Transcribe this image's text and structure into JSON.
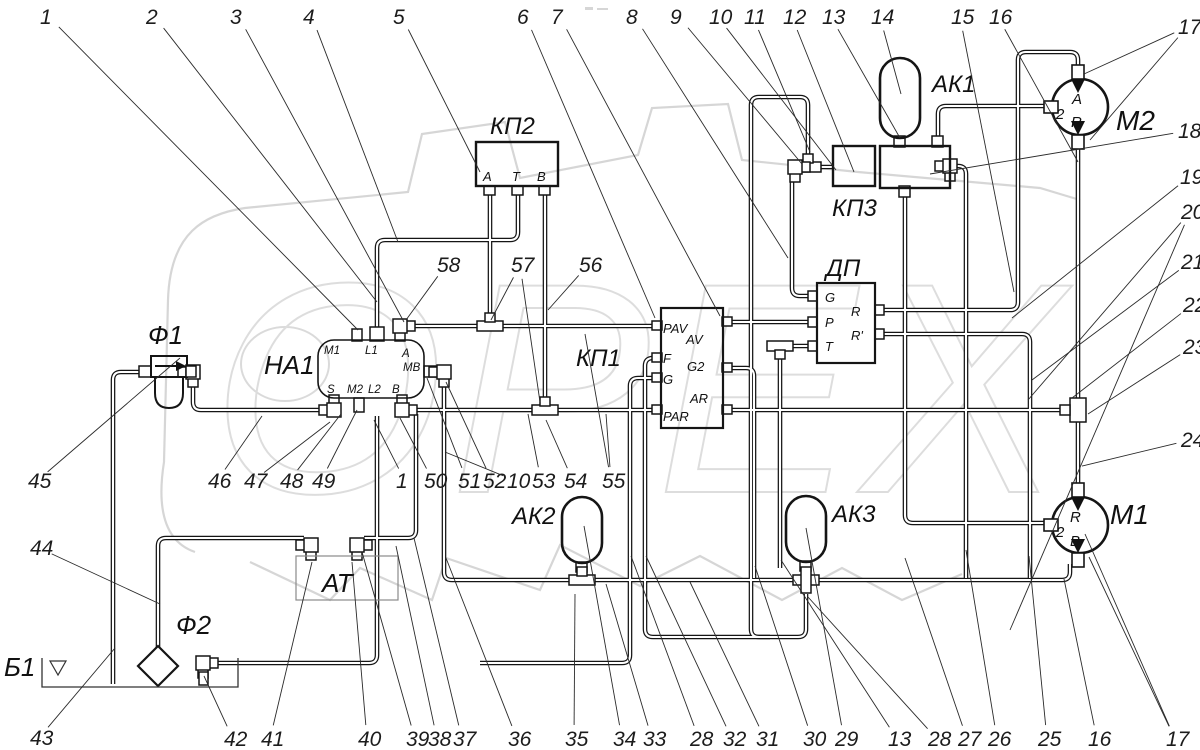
{
  "watermark": {
    "text": "ОРЕХ"
  },
  "blocks": [
    {
      "id": "kp2",
      "label": "КП2",
      "label_pos": [
        490,
        134
      ],
      "ports": [
        {
          "t": "А",
          "p": [
            483,
            181
          ]
        },
        {
          "t": "Т",
          "p": [
            512,
            181
          ]
        },
        {
          "t": "В",
          "p": [
            537,
            181
          ]
        }
      ]
    },
    {
      "id": "kp3",
      "label": "КП3",
      "label_pos": [
        832,
        216
      ],
      "ports": []
    },
    {
      "id": "na1",
      "label": "НА1",
      "label_pos": [
        264,
        374
      ],
      "ports": [
        {
          "t": "M1",
          "p": [
            324,
            354
          ]
        },
        {
          "t": "L1",
          "p": [
            365,
            354
          ]
        },
        {
          "t": "A",
          "p": [
            402,
            357
          ]
        },
        {
          "t": "MB",
          "p": [
            403,
            371
          ]
        },
        {
          "t": "S",
          "p": [
            327,
            393
          ]
        },
        {
          "t": "M2",
          "p": [
            347,
            393
          ]
        },
        {
          "t": "L2",
          "p": [
            368,
            393
          ]
        },
        {
          "t": "B",
          "p": [
            392,
            393
          ]
        }
      ]
    },
    {
      "id": "kp1",
      "label": "КП1",
      "label_pos": [
        576,
        366
      ],
      "ports": [
        {
          "t": "PAV",
          "p": [
            663,
            333
          ]
        },
        {
          "t": "AV",
          "p": [
            686,
            344
          ]
        },
        {
          "t": "F",
          "p": [
            663,
            363
          ]
        },
        {
          "t": "G",
          "p": [
            663,
            384
          ]
        },
        {
          "t": "G2",
          "p": [
            687,
            371
          ]
        },
        {
          "t": "AR",
          "p": [
            690,
            403
          ]
        },
        {
          "t": "PAR",
          "p": [
            663,
            421
          ]
        }
      ]
    },
    {
      "id": "dp",
      "label": "ДП",
      "label_pos": [
        826,
        276
      ],
      "ports": [
        {
          "t": "G",
          "p": [
            825,
            302
          ]
        },
        {
          "t": "P",
          "p": [
            825,
            327
          ]
        },
        {
          "t": "T",
          "p": [
            825,
            351
          ]
        },
        {
          "t": "R",
          "p": [
            851,
            316
          ]
        },
        {
          "t": "R'",
          "p": [
            851,
            340
          ]
        }
      ]
    },
    {
      "id": "ak1",
      "label": "АК1",
      "label_pos": [
        932,
        92
      ],
      "ports": []
    },
    {
      "id": "ak2",
      "label": "АК2",
      "label_pos": [
        512,
        524
      ],
      "ports": []
    },
    {
      "id": "ak3",
      "label": "АК3",
      "label_pos": [
        832,
        522
      ],
      "ports": []
    },
    {
      "id": "m2",
      "label": "М2",
      "label_pos": [
        1116,
        130
      ],
      "ports": [
        {
          "t": "2",
          "p": [
            1056,
            119
          ]
        },
        {
          "t": "A",
          "p": [
            1072,
            104
          ]
        },
        {
          "t": "R",
          "p": [
            1071,
            127
          ]
        }
      ]
    },
    {
      "id": "m1",
      "label": "М1",
      "label_pos": [
        1110,
        524
      ],
      "ports": [
        {
          "t": "2",
          "p": [
            1056,
            537
          ]
        },
        {
          "t": "R",
          "p": [
            1070,
            522
          ]
        },
        {
          "t": "B",
          "p": [
            1070,
            546
          ]
        }
      ]
    },
    {
      "id": "f1",
      "label": "Ф1",
      "label_pos": [
        148,
        344
      ],
      "ports": []
    },
    {
      "id": "f2",
      "label": "Ф2",
      "label_pos": [
        176,
        634
      ],
      "ports": []
    },
    {
      "id": "at",
      "label": "АТ",
      "label_pos": [
        322,
        592
      ],
      "ports": []
    },
    {
      "id": "b1",
      "label": "Б1",
      "label_pos": [
        4,
        676
      ],
      "ports": []
    }
  ],
  "callouts": [
    {
      "n": "1",
      "pos": [
        40,
        24
      ],
      "targets": [
        [
          358,
          330
        ]
      ]
    },
    {
      "n": "2",
      "pos": [
        146,
        24
      ],
      "targets": [
        [
          377,
          302
        ]
      ]
    },
    {
      "n": "3",
      "pos": [
        230,
        24
      ],
      "targets": [
        [
          404,
          322
        ]
      ]
    },
    {
      "n": "4",
      "pos": [
        303,
        24
      ],
      "targets": [
        [
          398,
          242
        ]
      ]
    },
    {
      "n": "5",
      "pos": [
        393,
        24
      ],
      "targets": [
        [
          480,
          172
        ]
      ]
    },
    {
      "n": "6",
      "pos": [
        517,
        24
      ],
      "targets": [
        [
          655,
          318
        ]
      ]
    },
    {
      "n": "7",
      "pos": [
        551,
        24
      ],
      "targets": [
        [
          720,
          316
        ]
      ]
    },
    {
      "n": "8",
      "pos": [
        626,
        24
      ],
      "targets": [
        [
          788,
          258
        ]
      ]
    },
    {
      "n": "9",
      "pos": [
        670,
        24
      ],
      "targets": [
        [
          802,
          164
        ]
      ]
    },
    {
      "n": "10",
      "pos": [
        709,
        24
      ],
      "targets": [
        [
          836,
          170
        ]
      ]
    },
    {
      "n": "11",
      "pos": [
        744,
        24
      ],
      "targets": [
        [
          810,
          152
        ]
      ]
    },
    {
      "n": "12",
      "pos": [
        783,
        24
      ],
      "targets": [
        [
          854,
          172
        ]
      ]
    },
    {
      "n": "13",
      "pos": [
        822,
        24
      ],
      "targets": [
        [
          900,
          138
        ]
      ]
    },
    {
      "n": "14",
      "pos": [
        871,
        24
      ],
      "targets": [
        [
          901,
          94
        ]
      ]
    },
    {
      "n": "15",
      "pos": [
        951,
        24
      ],
      "targets": [
        [
          1014,
          292
        ]
      ]
    },
    {
      "n": "16",
      "pos": [
        989,
        24
      ],
      "targets": [
        [
          1078,
          162
        ]
      ]
    },
    {
      "n": "17",
      "pos": [
        1178,
        34
      ],
      "targets": [
        [
          1084,
          74
        ],
        [
          1090,
          140
        ]
      ]
    },
    {
      "n": "18",
      "pos": [
        1178,
        138
      ],
      "targets": [
        [
          930,
          174
        ]
      ]
    },
    {
      "n": "19",
      "pos": [
        1180,
        184
      ],
      "targets": [
        [
          1012,
          318
        ]
      ]
    },
    {
      "n": "20",
      "pos": [
        1181,
        219
      ],
      "targets": [
        [
          1028,
          400
        ],
        [
          1010,
          630
        ]
      ]
    },
    {
      "n": "21",
      "pos": [
        1181,
        269
      ],
      "targets": [
        [
          1032,
          380
        ]
      ]
    },
    {
      "n": "22",
      "pos": [
        1183,
        312
      ],
      "targets": [
        [
          1072,
          398
        ]
      ]
    },
    {
      "n": "23",
      "pos": [
        1183,
        354
      ],
      "targets": [
        [
          1088,
          414
        ]
      ]
    },
    {
      "n": "24",
      "pos": [
        1181,
        447
      ],
      "targets": [
        [
          1082,
          466
        ]
      ]
    },
    {
      "n": "45",
      "pos": [
        28,
        488
      ],
      "targets": [
        [
          180,
          358
        ]
      ]
    },
    {
      "n": "44",
      "pos": [
        30,
        555
      ],
      "targets": [
        [
          160,
          604
        ]
      ]
    },
    {
      "n": "43",
      "pos": [
        30,
        745
      ],
      "targets": [
        [
          115,
          648
        ]
      ]
    },
    {
      "n": "46",
      "pos": [
        208,
        488
      ],
      "targets": [
        [
          262,
          416
        ]
      ]
    },
    {
      "n": "47",
      "pos": [
        244,
        488
      ],
      "targets": [
        [
          330,
          422
        ]
      ]
    },
    {
      "n": "48",
      "pos": [
        280,
        488
      ],
      "targets": [
        [
          341,
          414
        ]
      ]
    },
    {
      "n": "49",
      "pos": [
        312,
        488
      ],
      "targets": [
        [
          357,
          410
        ]
      ]
    },
    {
      "n": "1",
      "pos": [
        396,
        488
      ],
      "targets": [
        [
          374,
          420
        ]
      ]
    },
    {
      "n": "50",
      "pos": [
        424,
        488
      ],
      "targets": [
        [
          400,
          418
        ]
      ]
    },
    {
      "n": "51",
      "pos": [
        458,
        488
      ],
      "targets": [
        [
          427,
          378
        ]
      ]
    },
    {
      "n": "52",
      "pos": [
        483,
        488
      ],
      "targets": [
        [
          446,
          382
        ]
      ]
    },
    {
      "n": "10",
      "pos": [
        507,
        488
      ],
      "targets": [
        [
          445,
          452
        ]
      ]
    },
    {
      "n": "53",
      "pos": [
        532,
        488
      ],
      "targets": [
        [
          528,
          414
        ]
      ]
    },
    {
      "n": "54",
      "pos": [
        564,
        488
      ],
      "targets": [
        [
          546,
          420
        ]
      ]
    },
    {
      "n": "55",
      "pos": [
        602,
        488
      ],
      "targets": [
        [
          585,
          334
        ],
        [
          606,
          414
        ]
      ]
    },
    {
      "n": "58",
      "pos": [
        437,
        272
      ],
      "targets": [
        [
          406,
          320
        ]
      ]
    },
    {
      "n": "57",
      "pos": [
        511,
        272
      ],
      "targets": [
        [
          491,
          320
        ],
        [
          540,
          402
        ]
      ]
    },
    {
      "n": "56",
      "pos": [
        579,
        272
      ],
      "targets": [
        [
          548,
          310
        ]
      ]
    },
    {
      "n": "42",
      "pos": [
        224,
        746
      ],
      "targets": [
        [
          204,
          676
        ]
      ]
    },
    {
      "n": "41",
      "pos": [
        261,
        746
      ],
      "targets": [
        [
          312,
          562
        ]
      ]
    },
    {
      "n": "40",
      "pos": [
        358,
        746
      ],
      "targets": [
        [
          352,
          562
        ]
      ]
    },
    {
      "n": "39",
      "pos": [
        406,
        746
      ],
      "targets": [
        [
          362,
          552
        ]
      ]
    },
    {
      "n": "38",
      "pos": [
        428,
        746
      ],
      "targets": [
        [
          396,
          546
        ]
      ]
    },
    {
      "n": "37",
      "pos": [
        453,
        746
      ],
      "targets": [
        [
          414,
          538
        ]
      ]
    },
    {
      "n": "36",
      "pos": [
        508,
        746
      ],
      "targets": [
        [
          446,
          558
        ]
      ]
    },
    {
      "n": "35",
      "pos": [
        565,
        746
      ],
      "targets": [
        [
          575,
          594
        ]
      ]
    },
    {
      "n": "34",
      "pos": [
        613,
        746
      ],
      "targets": [
        [
          584,
          526
        ]
      ]
    },
    {
      "n": "33",
      "pos": [
        643,
        746
      ],
      "targets": [
        [
          606,
          584
        ]
      ]
    },
    {
      "n": "28",
      "pos": [
        690,
        746
      ],
      "targets": [
        [
          631,
          556
        ]
      ]
    },
    {
      "n": "32",
      "pos": [
        723,
        746
      ],
      "targets": [
        [
          646,
          556
        ]
      ]
    },
    {
      "n": "31",
      "pos": [
        756,
        746
      ],
      "targets": [
        [
          690,
          582
        ]
      ]
    },
    {
      "n": "30",
      "pos": [
        803,
        746
      ],
      "targets": [
        [
          755,
          566
        ]
      ]
    },
    {
      "n": "29",
      "pos": [
        835,
        746
      ],
      "targets": [
        [
          806,
          528
        ]
      ]
    },
    {
      "n": "13",
      "pos": [
        888,
        746
      ],
      "targets": [
        [
          781,
          560
        ]
      ]
    },
    {
      "n": "28",
      "pos": [
        928,
        746
      ],
      "targets": [
        [
          808,
          597
        ]
      ]
    },
    {
      "n": "27",
      "pos": [
        958,
        746
      ],
      "targets": [
        [
          905,
          558
        ]
      ]
    },
    {
      "n": "26",
      "pos": [
        988,
        746
      ],
      "targets": [
        [
          966,
          550
        ]
      ]
    },
    {
      "n": "25",
      "pos": [
        1038,
        746
      ],
      "targets": [
        [
          1029,
          556
        ]
      ]
    },
    {
      "n": "16",
      "pos": [
        1088,
        746
      ],
      "targets": [
        [
          1064,
          579
        ]
      ]
    },
    {
      "n": "17",
      "pos": [
        1166,
        746
      ],
      "targets": [
        [
          1085,
          534
        ],
        [
          1089,
          557
        ]
      ]
    }
  ]
}
